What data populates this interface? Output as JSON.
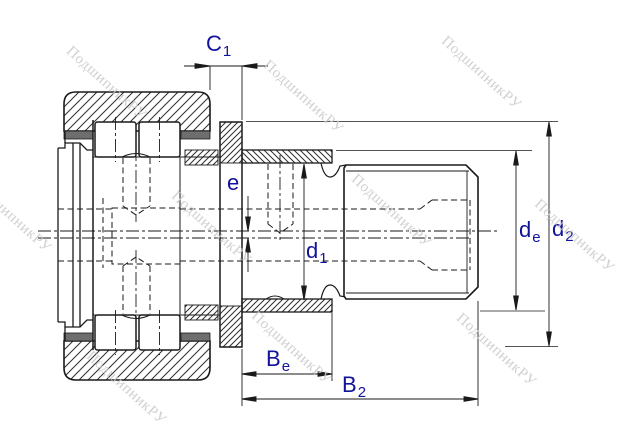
{
  "drawing": {
    "title": "cam-follower-bearing-cross-section"
  },
  "dimensions": {
    "c1": {
      "main": "C",
      "sub": "1"
    },
    "e": {
      "main": "e",
      "sub": ""
    },
    "d1": {
      "main": "d",
      "sub": "1"
    },
    "de": {
      "main": "d",
      "sub": "e"
    },
    "d2": {
      "main": "d",
      "sub": "2"
    },
    "be": {
      "main": "B",
      "sub": "e"
    },
    "b2": {
      "main": "B",
      "sub": "2"
    }
  },
  "watermark": {
    "text": "ПодшипникРУ",
    "color": "#c8c8c8",
    "positions": [
      {
        "x": 115,
        "y": 85
      },
      {
        "x": 312,
        "y": 99
      },
      {
        "x": 490,
        "y": 75
      },
      {
        "x": 20,
        "y": 218
      },
      {
        "x": 220,
        "y": 230
      },
      {
        "x": 400,
        "y": 213
      },
      {
        "x": 583,
        "y": 238
      },
      {
        "x": 135,
        "y": 390
      },
      {
        "x": 300,
        "y": 350
      },
      {
        "x": 505,
        "y": 352
      }
    ]
  },
  "colors": {
    "line": "#1a1a1a",
    "hatch": "#2e2e2e",
    "seal": "#6e6e6e",
    "label": "#12129a",
    "watermark": "#c8c8c8",
    "background": "#ffffff"
  }
}
